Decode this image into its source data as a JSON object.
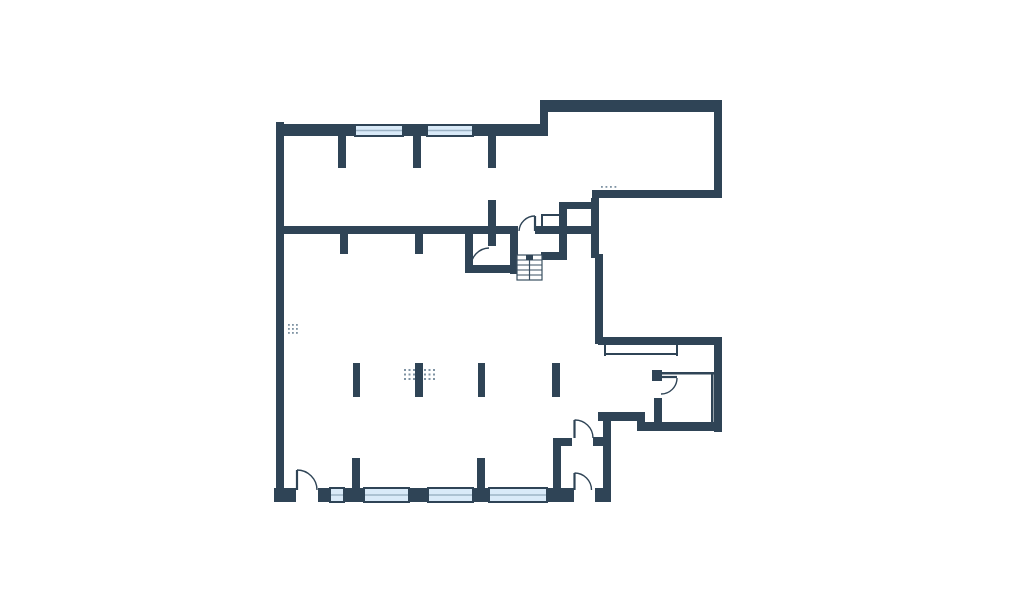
{
  "meta": {
    "type": "floor-plan",
    "background": "#ffffff"
  },
  "palette": {
    "wall": "#2f4456",
    "window_fill": "#d9eaf8",
    "window_mid_line": "#9db4c6",
    "thin": "#2f4456",
    "dots": "#7f93a3",
    "stair_line": "#3a4f61"
  },
  "plan": {
    "width": 1024,
    "height": 603,
    "walls": [
      [
        276,
        122,
        8,
        380,
        "exterior-left-wall"
      ],
      [
        276,
        124,
        272,
        12,
        "exterior-top-wall"
      ],
      [
        540,
        100,
        8,
        36,
        "top-step-wall"
      ],
      [
        540,
        100,
        182,
        12,
        "top-right-room-top-wall"
      ],
      [
        714,
        100,
        8,
        98,
        "right-wall-upper"
      ],
      [
        592,
        190,
        130,
        8,
        "top-right-room-bottom-wall"
      ],
      [
        591,
        198,
        8,
        60,
        "mid-right-wall-upper"
      ],
      [
        595,
        254,
        8,
        90,
        "mid-right-wall-lower"
      ],
      [
        598,
        337,
        124,
        8,
        "balcony-top-wall"
      ],
      [
        714,
        337,
        8,
        95,
        "right-wall-lower"
      ],
      [
        637,
        422,
        85,
        9,
        "bottom-right-wall"
      ],
      [
        637,
        412,
        8,
        14,
        "bottom-right-step-stub"
      ],
      [
        598,
        412,
        47,
        9,
        "bottom-right-ledge-wall"
      ],
      [
        603,
        412,
        8,
        90,
        "vestibule-right-wall"
      ],
      [
        274,
        488,
        22,
        14,
        "bottom-wall-left-corner"
      ],
      [
        318,
        488,
        12,
        14,
        "bottom-wall-door-jamb"
      ],
      [
        344,
        488,
        20,
        14,
        "bottom-wall-pier-1"
      ],
      [
        409,
        488,
        19,
        14,
        "bottom-wall-pier-2"
      ],
      [
        473,
        488,
        16,
        14,
        "bottom-wall-pier-3"
      ],
      [
        547,
        488,
        27,
        14,
        "bottom-wall-pier-4"
      ],
      [
        595,
        488,
        16,
        14,
        "bottom-wall-right-end"
      ],
      [
        284,
        226,
        234,
        8,
        "interior-main-wall"
      ],
      [
        340,
        234,
        8,
        20,
        "interior-wall-stub-a"
      ],
      [
        415,
        234,
        8,
        20,
        "interior-wall-stub-b"
      ],
      [
        488,
        200,
        8,
        46,
        "interior-cross-stub"
      ],
      [
        510,
        226,
        8,
        48,
        "stair-hall-left-wall"
      ],
      [
        535,
        226,
        64,
        8,
        "stair-hall-top-wall"
      ],
      [
        559,
        202,
        8,
        58,
        "closet-left-wall"
      ],
      [
        559,
        202,
        40,
        7,
        "closet-top-wall"
      ],
      [
        541,
        252,
        20,
        8,
        "stair-hall-bottom-wall"
      ],
      [
        465,
        233,
        8,
        40,
        "room-a-left-wall"
      ],
      [
        465,
        265,
        53,
        8,
        "room-a-bottom-wall"
      ],
      [
        553,
        438,
        8,
        54,
        "vestibule-left-wall"
      ],
      [
        553,
        438,
        19,
        8,
        "vestibule-top-stub"
      ],
      [
        593,
        437,
        10,
        9,
        "vestibule-top-jamb"
      ],
      [
        338,
        136,
        8,
        32,
        "top-wall-stub-a"
      ],
      [
        413,
        136,
        8,
        32,
        "top-wall-stub-b"
      ],
      [
        488,
        136,
        8,
        32,
        "top-wall-stub-c"
      ],
      [
        353,
        363,
        7,
        34,
        "column-stub-1"
      ],
      [
        415,
        363,
        8,
        34,
        "column-stub-2"
      ],
      [
        478,
        363,
        7,
        34,
        "column-stub-3"
      ],
      [
        552,
        363,
        8,
        34,
        "column-stub-4"
      ],
      [
        352,
        458,
        8,
        30,
        "bottom-wall-stub-1"
      ],
      [
        477,
        458,
        8,
        30,
        "bottom-wall-stub-2"
      ],
      [
        654,
        398,
        8,
        24,
        "entry-room-left-wall"
      ],
      [
        652,
        370,
        10,
        11,
        "entry-room-hinge-block"
      ]
    ],
    "windows": [
      [
        355,
        125,
        48,
        11,
        "top-window-1"
      ],
      [
        427,
        125,
        46,
        11,
        "top-window-2"
      ],
      [
        330,
        488,
        14,
        14,
        "bottom-window-1"
      ],
      [
        364,
        488,
        45,
        14,
        "bottom-window-2"
      ],
      [
        428,
        488,
        45,
        14,
        "bottom-window-3"
      ],
      [
        489,
        488,
        58,
        14,
        "bottom-window-4"
      ]
    ],
    "thin_lines": [
      [
        604,
        345,
        2,
        11,
        "balcony-left-line"
      ],
      [
        604,
        353,
        74,
        2,
        "balcony-bottom-line"
      ],
      [
        676,
        345,
        2,
        11,
        "balcony-right-line"
      ],
      [
        652,
        372,
        62,
        2.5,
        "entry-room-top-line"
      ],
      [
        711,
        373,
        2.5,
        53,
        "entry-room-right-line"
      ],
      [
        541,
        214,
        2,
        13,
        "shaft-left-line"
      ],
      [
        541,
        214,
        18,
        2,
        "shaft-top-line"
      ]
    ],
    "doors": [
      {
        "name": "door-stair-hall",
        "leaf": [
          535,
          216,
          535,
          231
        ],
        "arc": [
          519,
          231,
          535,
          216,
          16,
          1
        ]
      },
      {
        "name": "door-room-a",
        "leaf": null,
        "arc": [
          471,
          267,
          489,
          248,
          18.5,
          1
        ]
      },
      {
        "name": "door-vestibule-top",
        "leaf": [
          574.5,
          420,
          574.5,
          438
        ],
        "arc": [
          574.5,
          420,
          593,
          438,
          18,
          1
        ]
      },
      {
        "name": "door-vestibule-bottom",
        "leaf": [
          574.5,
          473,
          574.5,
          490
        ],
        "arc": [
          574.5,
          473,
          591.5,
          490,
          17,
          1
        ]
      },
      {
        "name": "door-main-entrance",
        "leaf": [
          297,
          470,
          297,
          490
        ],
        "arc": [
          297,
          470,
          317,
          490,
          20,
          1
        ]
      },
      {
        "name": "door-entry-room",
        "leaf": [
          661,
          377,
          677,
          377
        ],
        "arc": [
          677,
          378,
          661,
          394,
          16,
          1
        ]
      }
    ],
    "stairs": {
      "x": 517,
      "y": 255,
      "w": 25,
      "h": 25,
      "steps": 5,
      "rail": true,
      "blob": [
        526,
        255,
        7,
        5
      ]
    },
    "dot_groups": [
      {
        "name": "vent-dots-left-wall",
        "x": 288,
        "y": 324,
        "cols": 3,
        "rows": 3,
        "dx": 4,
        "dy": 4,
        "size": 1.8
      },
      {
        "name": "vent-dots-top-right",
        "x": 601,
        "y": 186,
        "cols": 4,
        "rows": 1,
        "dx": 4.5,
        "dy": 0,
        "size": 1.8
      },
      {
        "name": "vent-dots-center-1",
        "x": 404,
        "y": 369,
        "cols": 3,
        "rows": 3,
        "dx": 4.5,
        "dy": 4.5,
        "size": 2
      },
      {
        "name": "vent-dots-center-2",
        "x": 424,
        "y": 369,
        "cols": 3,
        "rows": 3,
        "dx": 4.5,
        "dy": 4.5,
        "size": 2
      }
    ]
  }
}
